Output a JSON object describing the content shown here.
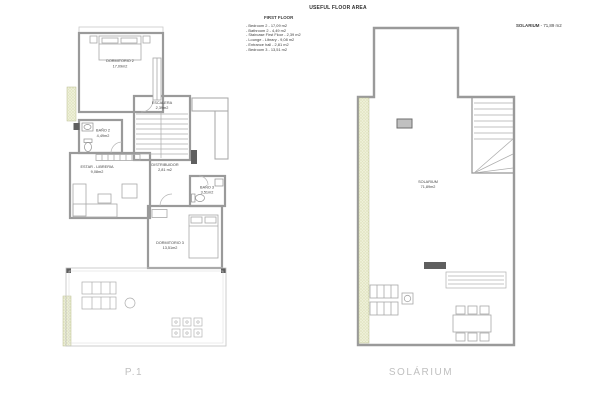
{
  "title": "USEFUL FLOOR AREA",
  "legend": {
    "heading": "FIRST FLOOR",
    "items": [
      "- Bedroom 2 - 17,09 m2",
      "- Bathroom 2 - 4,49 m2",
      "- Staircase First Floor - 2,39 m2",
      "- Lounge - Library - 9,08 m2",
      "- Entrance hall - 2,81 m2",
      "- Bedroom 3 - 13,51 m2"
    ]
  },
  "sol_header": {
    "label": "SOLARIUM",
    "value": " - 71,89 m2"
  },
  "floor_plan": {
    "caption": "P.1",
    "rooms": [
      {
        "name": "DORMITORIO 2",
        "area": "17,09m2"
      },
      {
        "name": "BAÑO 2",
        "area": "4,49m2"
      },
      {
        "name": "ESCALERA",
        "area": "2,39m2"
      },
      {
        "name": "DISTRIBUIDOR",
        "area": "2,81 m2"
      },
      {
        "name": "ESTAR - LIBRERIA",
        "area": "9,08m2"
      },
      {
        "name": "BAÑO 3",
        "area": "3,51m2"
      },
      {
        "name": "DORMITORIO 3",
        "area": "13,51m2"
      }
    ]
  },
  "solarium_plan": {
    "caption": "SOLÁRIUM",
    "room": {
      "name": "SOLARIUM",
      "area": "71,89m2"
    }
  },
  "colors": {
    "wall": "#9a9a9a",
    "thin_line": "#b5b5b5",
    "hatch_fill": "#eef0d8",
    "hatch_dot": "#c2c98e",
    "dark_element": "#5f5f5f",
    "caption_gray": "#c0c0c0",
    "text": "#3d3d3d"
  }
}
